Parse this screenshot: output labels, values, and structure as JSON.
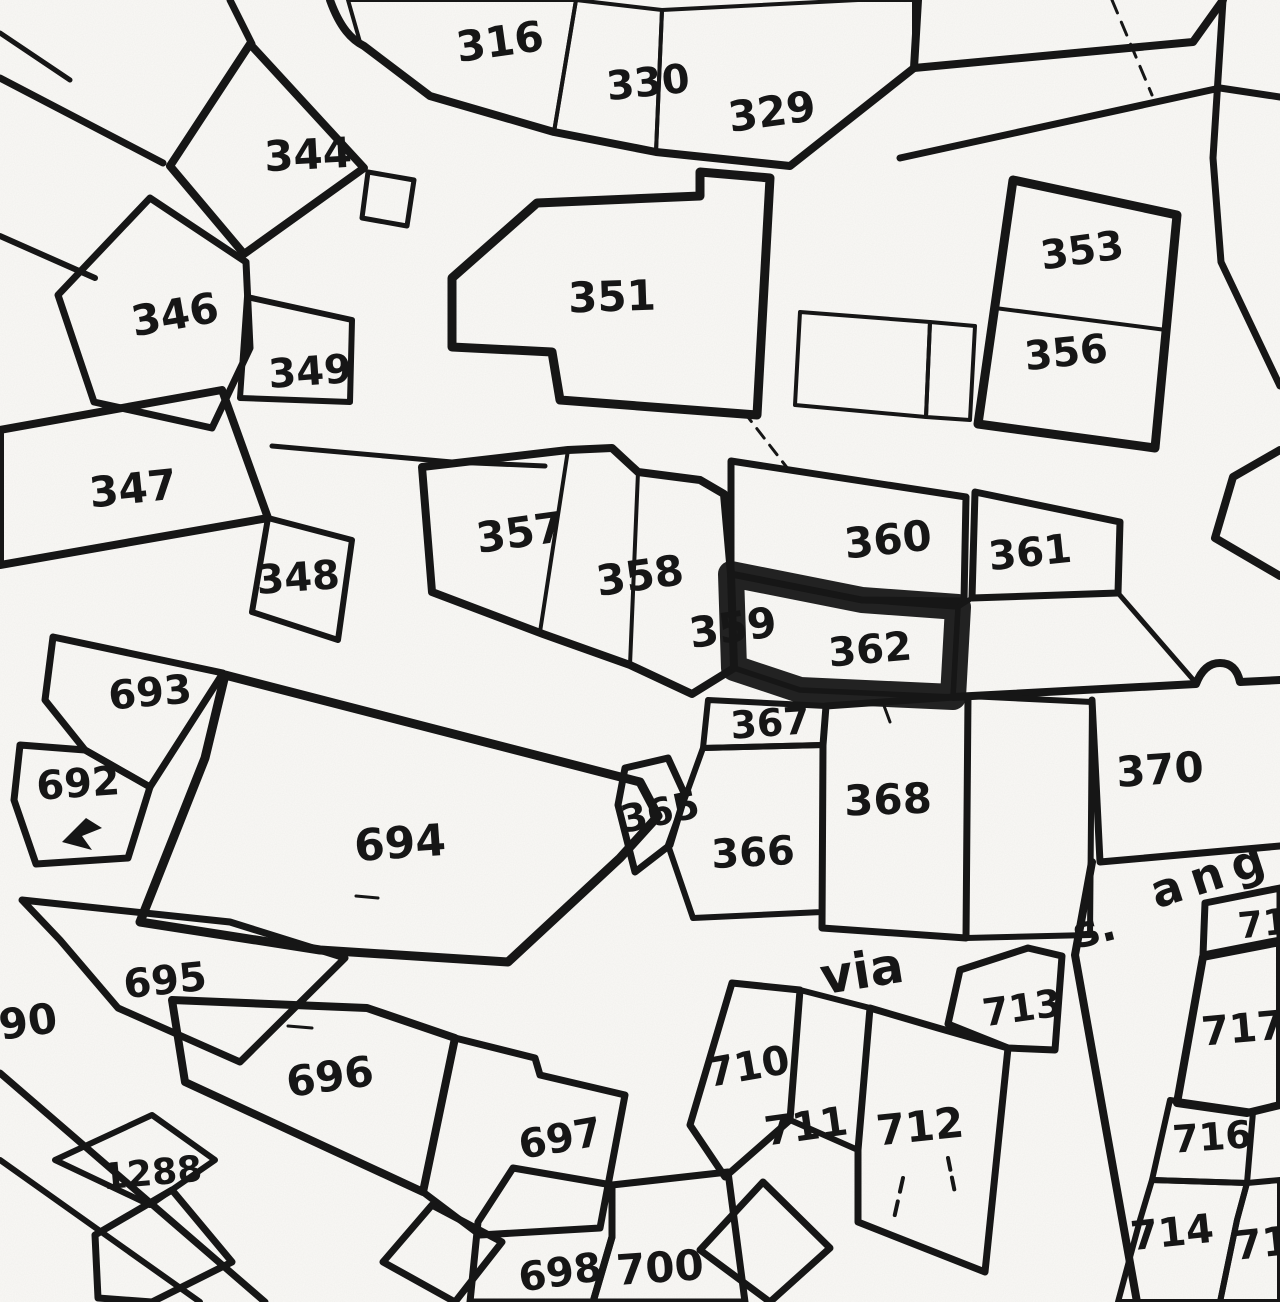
{
  "map": {
    "type": "cadastral parcel map (black and white scan)",
    "highlighted_parcel": "362",
    "colors": {
      "paper": "#faf9f6",
      "ink": "#161616",
      "highlight": "#c8c6c1"
    },
    "street": {
      "via": "via",
      "s": "s.",
      "ang": "ang"
    },
    "parcel_labels": {
      "n316": "316",
      "n330": "330",
      "n329": "329",
      "n344": "344",
      "n353": "353",
      "n356": "356",
      "n346": "346",
      "n349": "349",
      "n351": "351",
      "n347": "347",
      "n348": "348",
      "n357": "357",
      "n358": "358",
      "n359": "359",
      "n360": "360",
      "n361": "361",
      "n362": "362",
      "n693": "693",
      "n692": "692",
      "n694": "694",
      "n365": "365",
      "n366": "366",
      "n367": "367",
      "n368": "368",
      "n370": "370",
      "n695": "695",
      "n90": "90",
      "n696": "696",
      "n1288": "1288",
      "n697": "697",
      "n698": "698",
      "n700": "700",
      "n710": "710",
      "n711": "711",
      "n712": "712",
      "n713": "713",
      "n717": "717",
      "n716": "716",
      "n714": "714",
      "n715_partial": "71",
      "n718_partial": "71"
    }
  }
}
